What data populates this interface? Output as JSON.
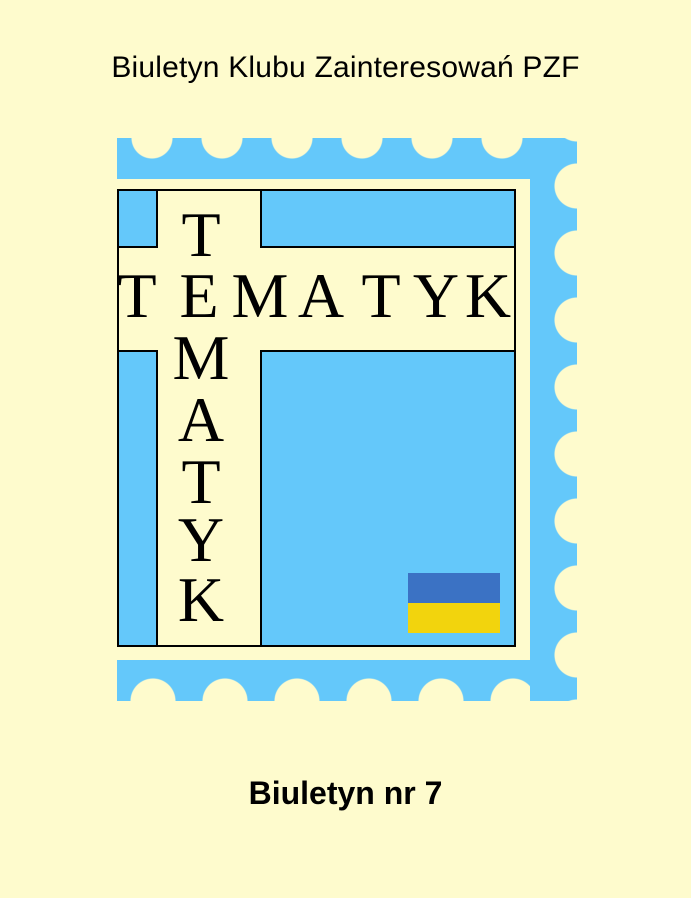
{
  "header": {
    "title": "Biuletyn Klubu Zainteresowań PZF"
  },
  "stamp": {
    "horizontal_word": "TEMATYK",
    "vertical_word": "TEMATYK",
    "h_letters": [
      "T",
      "E",
      "M",
      "A",
      "T",
      "Y",
      "K"
    ],
    "v_letters": [
      "T",
      "M",
      "A",
      "T",
      "Y",
      "K"
    ],
    "colors": {
      "stamp_blue": "#64C8FA",
      "paper_cream": "#FEFBCD",
      "flag_blue": "#3B72C4",
      "flag_yellow": "#F2D40D",
      "ink_black": "#000000"
    }
  },
  "footer": {
    "issue_label": "Biuletyn nr 7"
  }
}
